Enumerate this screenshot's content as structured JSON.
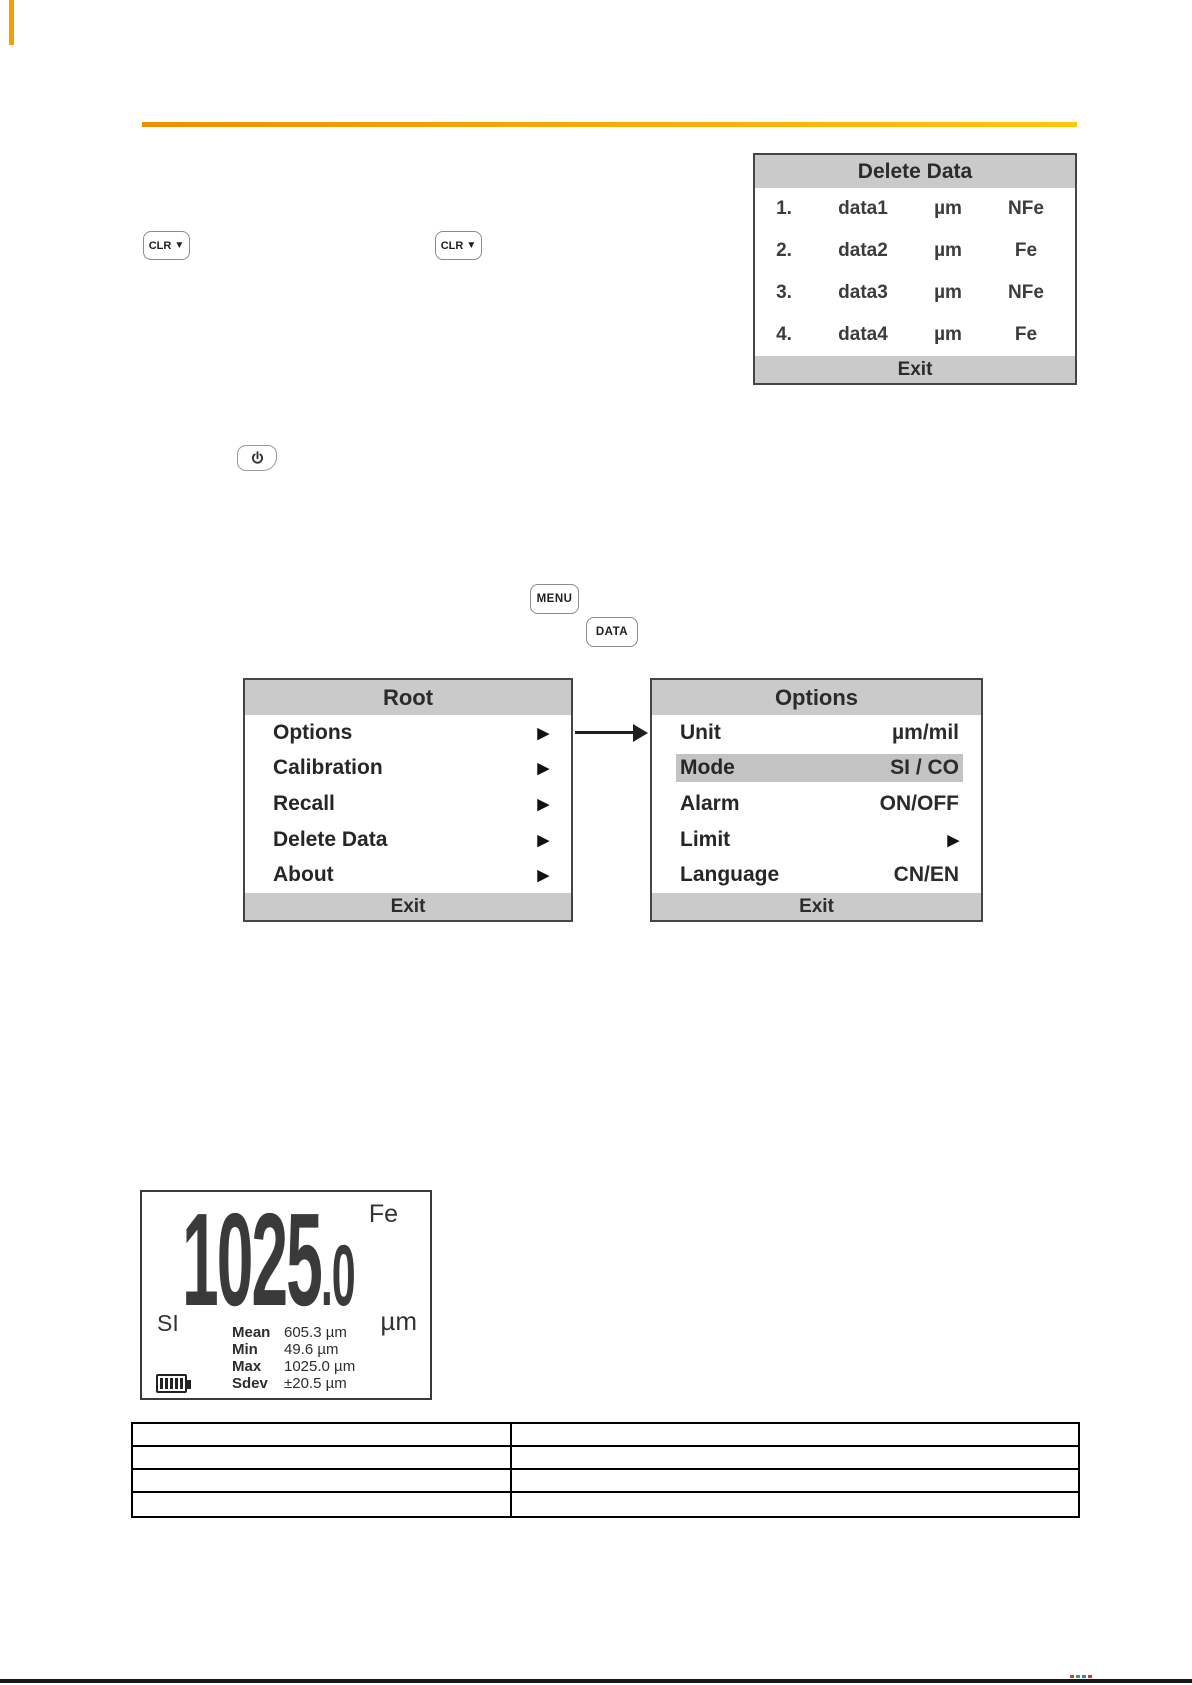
{
  "colors": {
    "accent_orange_left": "#f09000",
    "accent_orange_right": "#ffc60a",
    "lcd_bar_gray": "#cacaca",
    "highlight_gray": "#c3c3c3",
    "text_dark": "#2e2e2e",
    "bottom_rule_black": "#171717"
  },
  "keys": {
    "clr": {
      "label": "CLR",
      "icon": "▼"
    },
    "menu": {
      "label": "MENU"
    },
    "data": {
      "label": "DATA"
    }
  },
  "screens": {
    "delete_data": {
      "title": "Delete Data",
      "rows": [
        {
          "index": "1.",
          "name": "data1",
          "unit": "µm",
          "type": "NFe"
        },
        {
          "index": "2.",
          "name": "data2",
          "unit": "µm",
          "type": "Fe"
        },
        {
          "index": "3.",
          "name": "data3",
          "unit": "µm",
          "type": "NFe"
        },
        {
          "index": "4.",
          "name": "data4",
          "unit": "µm",
          "type": "Fe"
        }
      ],
      "exit": "Exit"
    },
    "root": {
      "title": "Root",
      "submenu_arrow": "▶",
      "items": [
        {
          "label": "Options"
        },
        {
          "label": "Calibration"
        },
        {
          "label": "Recall"
        },
        {
          "label": "Delete Data"
        },
        {
          "label": "About"
        }
      ],
      "exit": "Exit"
    },
    "options": {
      "title": "Options",
      "items": [
        {
          "label": "Unit",
          "value": "µm/mil"
        },
        {
          "label": "Mode",
          "value": "SI / CO",
          "highlighted": true
        },
        {
          "label": "Alarm",
          "value": "ON/OFF"
        },
        {
          "label": "Limit",
          "value": "▶"
        },
        {
          "label": "Language",
          "value": "CN/EN"
        }
      ],
      "exit": "Exit"
    },
    "measurement": {
      "reading": "1025",
      "decimal": ".0",
      "material": "Fe",
      "mode": "SI",
      "unit": "µm",
      "stats": [
        {
          "label": "Mean",
          "value": "605.3 µm"
        },
        {
          "label": "Min",
          "value": "49.6 µm"
        },
        {
          "label": "Max",
          "value": "1025.0 µm"
        },
        {
          "label": "Sdev",
          "value": "±20.5 µm"
        }
      ]
    }
  },
  "bottom_table": {
    "rows": 4,
    "columns": 2
  }
}
